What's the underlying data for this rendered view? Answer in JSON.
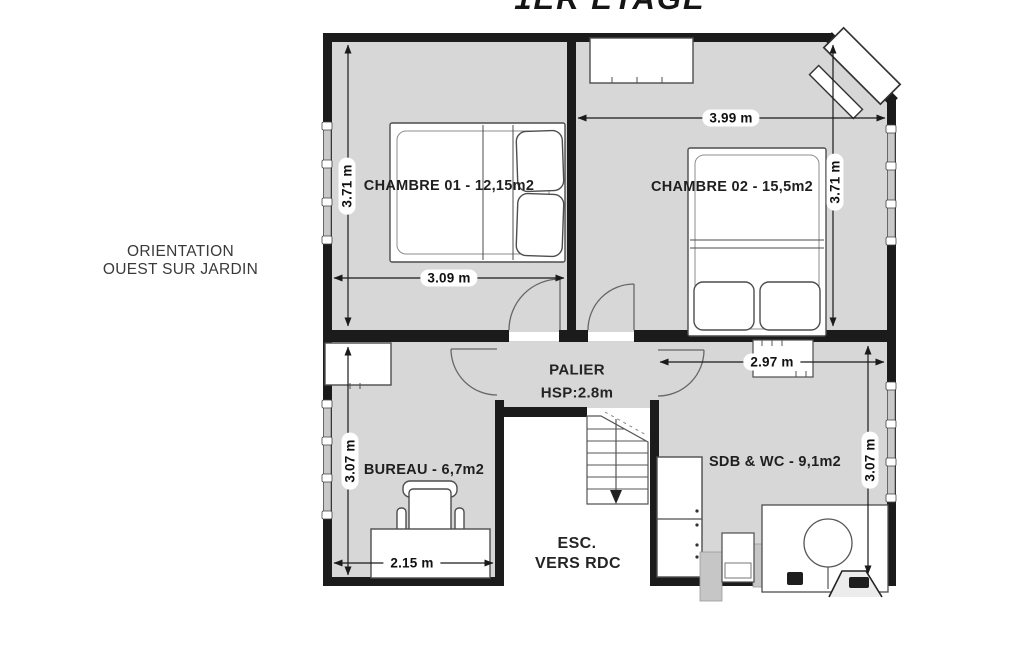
{
  "title": "1ER ÉTAGE",
  "orientation": {
    "line1": "ORIENTATION",
    "line2": "OUEST SUR JARDIN"
  },
  "rooms": {
    "chambre01": {
      "label": "CHAMBRE 01 - 12,15m2",
      "width": "3.09 m",
      "height": "3.71 m"
    },
    "chambre02": {
      "label": "CHAMBRE 02 - 15,5m2",
      "width": "3.99 m",
      "height": "3.71 m"
    },
    "bureau": {
      "label": "BUREAU - 6,7m2",
      "width": "2.15 m",
      "height": "3.07 m"
    },
    "sdb": {
      "label": "SDB & WC - 9,1m2",
      "width": "2.97 m",
      "height": "3.07 m"
    },
    "palier": {
      "label": "PALIER",
      "ceiling_height": "HSP:2.8m"
    },
    "stairs": {
      "line1": "ESC.",
      "line2": "VERS RDC"
    }
  },
  "colors": {
    "wall": "#1b1b1b",
    "room_fill": "#d7d7d7",
    "window_fill": "#c9c9c9",
    "paper": "#ffffff"
  }
}
